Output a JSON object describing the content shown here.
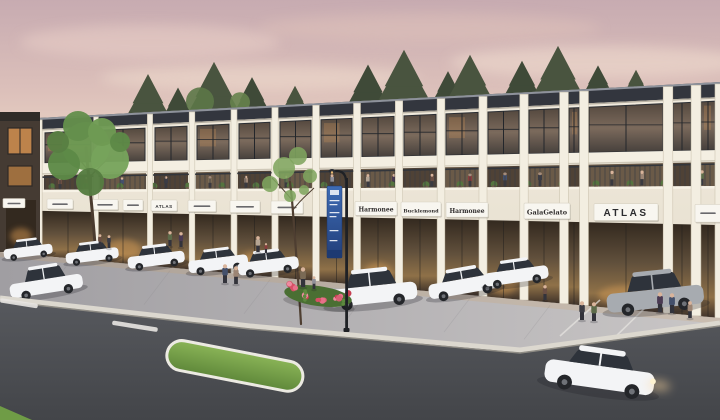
{
  "scene": {
    "title": "Retail promenade architectural rendering at dusk",
    "description": "Two-storey cream retail building with dark parapet roof, second-floor terrace dining behind railings, ground-floor storefronts with white sign boards, angled parking with white cars, pedestrians, a blue lamp-post banner, flower bed, grass median and asphalt boulevard in the foreground",
    "time_of_day": "dusk",
    "building_storeys": 2
  },
  "signs": [
    {
      "legible": false
    },
    {
      "legible": false
    },
    {
      "legible": false
    },
    {
      "legible": false
    },
    {
      "label": "ATLAS",
      "legible": true
    },
    {
      "legible": false
    },
    {
      "legible": false
    },
    {
      "legible": false
    },
    {
      "label": "Harmonee",
      "legible": true
    },
    {
      "label": "Bucklemond",
      "legible": true
    },
    {
      "label": "Harmonee",
      "legible": true
    },
    {
      "label": "GalaGelato",
      "legible": true
    },
    {
      "label": "ATLAS",
      "legible": true
    },
    {
      "legible": false
    }
  ],
  "palette": {
    "sky_top": "#c7abb1",
    "sky_horizon": "#f6ead6",
    "roof_parapet": "#33363e",
    "wall": "#ece4d4",
    "storefront_glow": "#c08a4f",
    "sign_board": "#f8f6f0",
    "sign_text": "#2b2b2e",
    "plaza_pavers": "#b3b1b4",
    "road_asphalt": "#4c4e53",
    "curb": "#dcd8cf",
    "grass": "#74a24a",
    "flowers": "#d95f74",
    "car_white": "#f3f4f6",
    "car_grey": "#a7abb0",
    "lamp_banner_blue": "#2d4f96",
    "tree_green": "#6e9a53",
    "conifer_green": "#49543f"
  }
}
